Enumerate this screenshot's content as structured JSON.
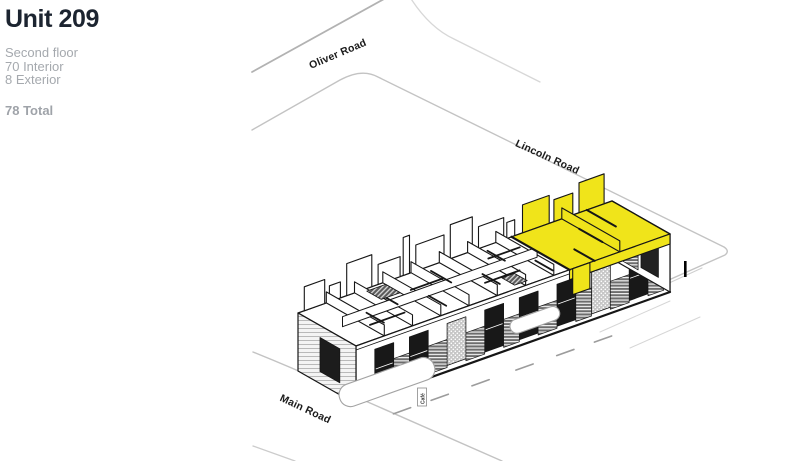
{
  "panel": {
    "title": "Unit 209",
    "floor": "Second floor",
    "interior": "70 Interior",
    "exterior": "8 Exterior",
    "total": "78 Total"
  },
  "roads": {
    "oliver": "Oliver Road",
    "lincoln": "Lincoln Road",
    "main": "Main Road"
  },
  "building": {
    "cafe_label": "Café",
    "highlight_unit": "209",
    "highlight_color": "#F0E41A",
    "ink_color": "#161616",
    "road_line_color": "#c3c3c3"
  }
}
